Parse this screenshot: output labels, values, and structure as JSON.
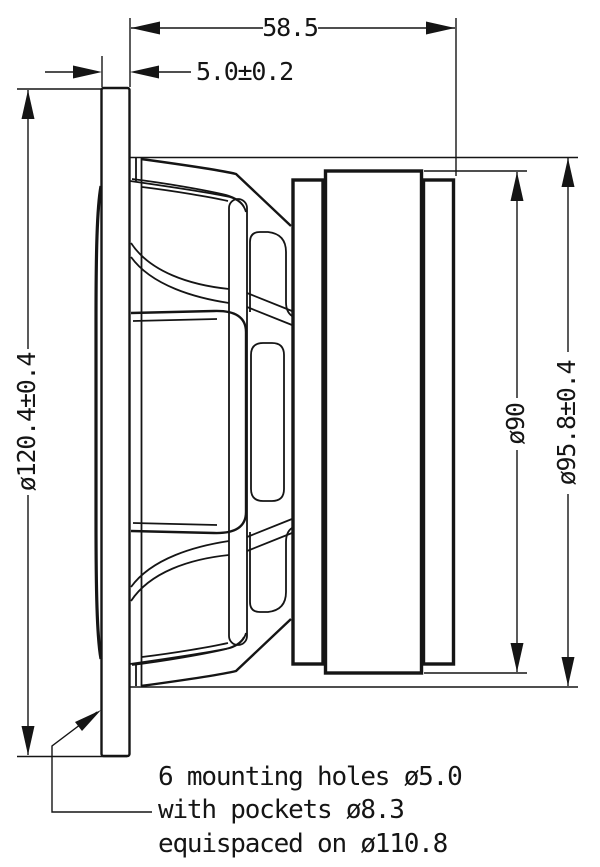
{
  "drawing": {
    "dimensions": {
      "depth_total": "58.5",
      "flange_thickness": "5.0±0.2",
      "flange_diameter": "ø120.4±0.4",
      "magnet_diameter": "ø90",
      "body_diameter": "ø95.8±0.4"
    },
    "mounting_note": {
      "line1": "6 mounting holes ø5.0",
      "line2": "with pockets ø8.3",
      "line3": "equispaced on ø110.8"
    },
    "colors": {
      "line": "#151515",
      "background": "#ffffff"
    }
  }
}
